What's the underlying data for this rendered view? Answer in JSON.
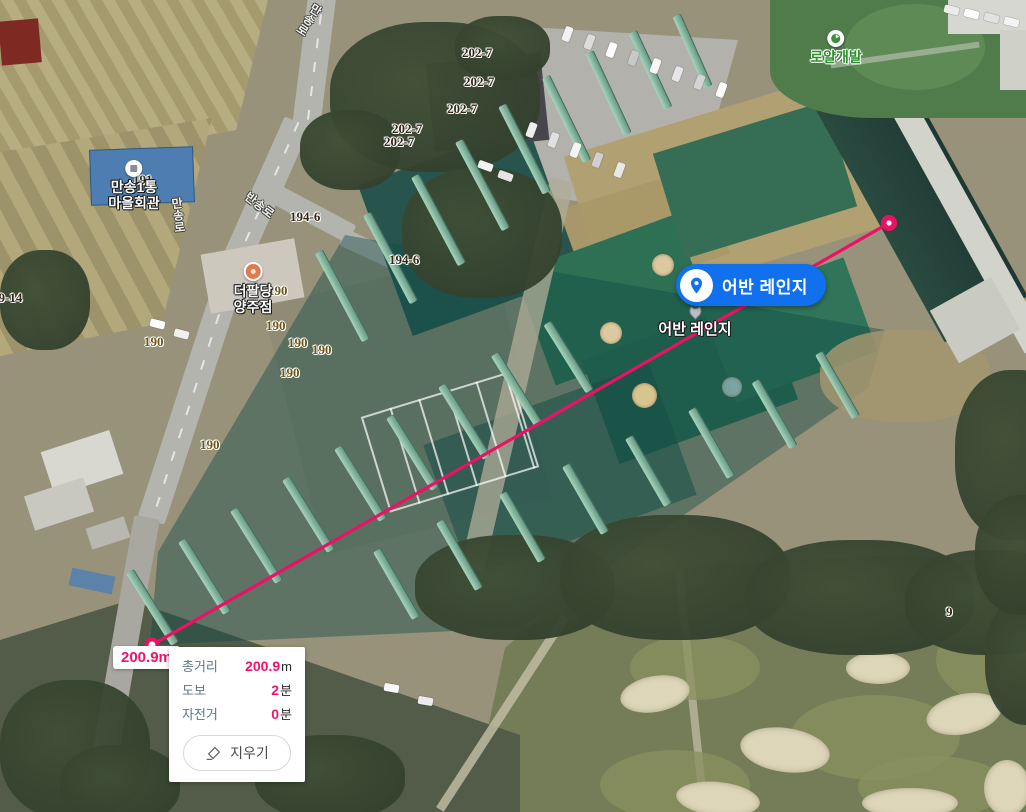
{
  "pois": {
    "main_pill": {
      "label": "어반 레인지"
    },
    "ground": {
      "label": "어반 레인지"
    },
    "royal": {
      "label": "로얄개발"
    },
    "village_hall": {
      "line1": "만송1통",
      "line2": "마을회관"
    },
    "restaurant": {
      "line1": "더팔당",
      "line2": "양주점"
    }
  },
  "road_labels": [
    {
      "text": "만송로",
      "x": 312,
      "y": 0,
      "rotate": 33,
      "vertical": true
    },
    {
      "text": "만송로",
      "x": 168,
      "y": 198,
      "rotate": -6,
      "vertical": true
    },
    {
      "text": "반송로",
      "x": 252,
      "y": 188,
      "rotate": 38,
      "vertical": false
    }
  ],
  "parcel_labels": [
    {
      "text": "202-7",
      "x": 462,
      "y": 45
    },
    {
      "text": "202-7",
      "x": 464,
      "y": 74
    },
    {
      "text": "202-7",
      "x": 447,
      "y": 101
    },
    {
      "text": "202-7",
      "x": 392,
      "y": 121
    },
    {
      "text": "202-7",
      "x": 384,
      "y": 134
    },
    {
      "text": "194-6",
      "x": 290,
      "y": 209
    },
    {
      "text": "194-6",
      "x": 389,
      "y": 252
    },
    {
      "text": "191",
      "x": 133,
      "y": 172
    },
    {
      "text": "190",
      "x": 268,
      "y": 283,
      "olive": true
    },
    {
      "text": "190",
      "x": 266,
      "y": 318,
      "olive": true
    },
    {
      "text": "190",
      "x": 144,
      "y": 334,
      "olive": true
    },
    {
      "text": "190",
      "x": 288,
      "y": 335,
      "olive": true
    },
    {
      "text": "190",
      "x": 312,
      "y": 342,
      "olive": true
    },
    {
      "text": "190",
      "x": 280,
      "y": 365,
      "olive": true
    },
    {
      "text": "190",
      "x": 200,
      "y": 437,
      "olive": true
    },
    {
      "text": "79-14",
      "x": -8,
      "y": 290
    },
    {
      "text": "9",
      "x": 946,
      "y": 604
    }
  ],
  "measurement": {
    "distance_badge": "200.9m",
    "line_color": "#ed1166",
    "start": {
      "x": 152,
      "y": 645
    },
    "end": {
      "x": 889,
      "y": 223
    },
    "panel": {
      "rows": [
        {
          "label": "총거리",
          "value": "200.9",
          "unit": "m"
        },
        {
          "label": "도보",
          "value": "2",
          "unit": "분"
        },
        {
          "label": "자전거",
          "value": "0",
          "unit": "분"
        }
      ],
      "clear_button_label": "지우기"
    }
  }
}
